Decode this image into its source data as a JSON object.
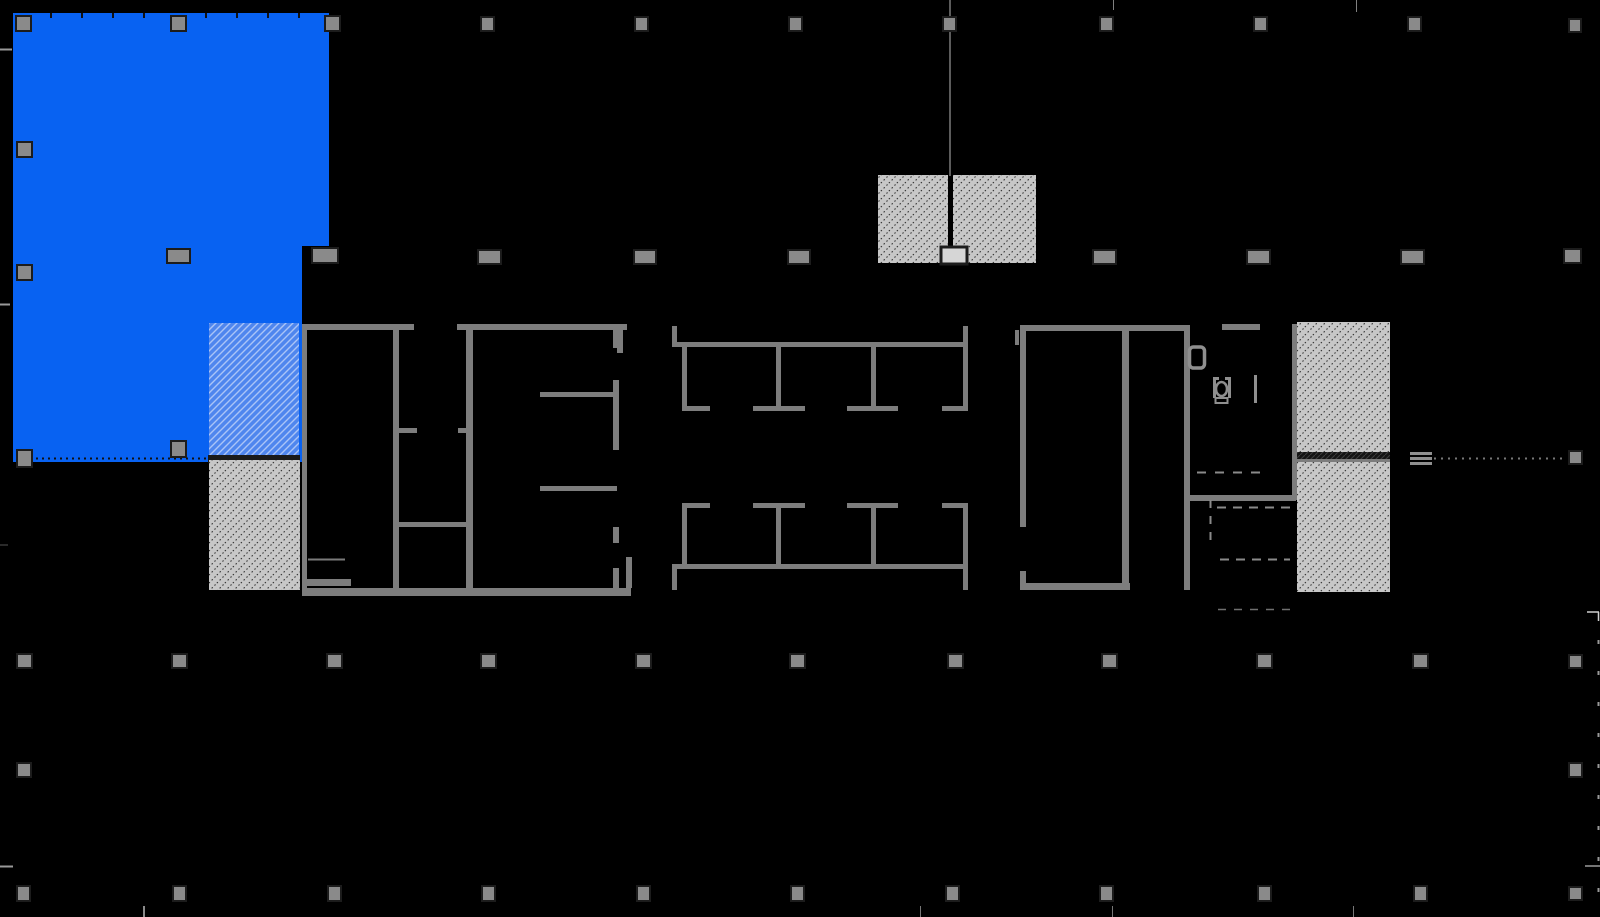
{
  "app": {
    "view_label": "floor-plan-view"
  },
  "canvas": {
    "width": 1600,
    "height": 917,
    "background": "#000000"
  },
  "palette": {
    "background": "#000000",
    "wall": "#7d7d7d",
    "wall_light": "#8f8f8f",
    "column_fill": "#8a8a8a",
    "column_border": "#1c1c1c",
    "selection_blue": "#0862f2",
    "hatch_gray_bg": "#c7c7c7",
    "hatch_gray_line": "#2f2f2f",
    "hatch_blue_bg": "#4f86ee",
    "hatch_blue_line": "#aac4f7",
    "dark_band": "#1a1a1a",
    "tick": "#999999"
  },
  "selection": {
    "suite_polygon": "13,13 329,13 329,246 302,246 302,462 13,462",
    "hatch_rect": [
      209,
      323,
      90,
      134
    ],
    "separator_band": [
      208,
      455,
      92,
      8
    ],
    "edge_dotted_line": {
      "x1": 30,
      "y1": 458.5,
      "x2": 208,
      "y2": 458.5,
      "color": "#101010",
      "dash": "2 4",
      "width": 2
    },
    "mullion_ticks_y": 13,
    "mullion_ticks_x": [
      50,
      81,
      112,
      143,
      205,
      236,
      267,
      298
    ]
  },
  "gray_hatches": [
    [
      209,
      460,
      91,
      130
    ],
    [
      878,
      175,
      70,
      88
    ],
    [
      953,
      175,
      83,
      88
    ],
    [
      1297,
      322,
      93,
      131
    ],
    [
      1297,
      462,
      93,
      130
    ]
  ],
  "dark_bands": [
    [
      1297,
      452,
      93,
      9
    ]
  ],
  "walls": [
    [
      302,
      324,
      112,
      6
    ],
    [
      457,
      324,
      170,
      6
    ],
    [
      302,
      325,
      5,
      271
    ],
    [
      393,
      330,
      6,
      258
    ],
    [
      399,
      428,
      18,
      5
    ],
    [
      458,
      428,
      15,
      5
    ],
    [
      399,
      522,
      74,
      5
    ],
    [
      302,
      579,
      49,
      7
    ],
    [
      302,
      588,
      329,
      8
    ],
    [
      466,
      330,
      7,
      266
    ],
    [
      613,
      330,
      6,
      18
    ],
    [
      613,
      380,
      6,
      70
    ],
    [
      613,
      527,
      6,
      16
    ],
    [
      613,
      568,
      6,
      20
    ],
    [
      540,
      392,
      77,
      5
    ],
    [
      540,
      486,
      77,
      5
    ],
    [
      626,
      557,
      6,
      31
    ],
    [
      617,
      326,
      6,
      27
    ],
    [
      672,
      326,
      5,
      21
    ],
    [
      677,
      342,
      286,
      5
    ],
    [
      963,
      326,
      5,
      21
    ],
    [
      682,
      347,
      5,
      62
    ],
    [
      963,
      347,
      5,
      62
    ],
    [
      776,
      347,
      5,
      61
    ],
    [
      871,
      347,
      5,
      61
    ],
    [
      682,
      406,
      28,
      5
    ],
    [
      753,
      406,
      52,
      5
    ],
    [
      847,
      406,
      51,
      5
    ],
    [
      942,
      406,
      26,
      5
    ],
    [
      682,
      503,
      28,
      5
    ],
    [
      753,
      503,
      52,
      5
    ],
    [
      847,
      503,
      51,
      5
    ],
    [
      942,
      503,
      26,
      5
    ],
    [
      776,
      508,
      5,
      61
    ],
    [
      871,
      508,
      5,
      61
    ],
    [
      682,
      508,
      5,
      61
    ],
    [
      963,
      508,
      5,
      61
    ],
    [
      677,
      564,
      286,
      5
    ],
    [
      672,
      564,
      5,
      26
    ],
    [
      963,
      564,
      5,
      26
    ],
    [
      1020,
      325,
      168,
      6
    ],
    [
      1020,
      325,
      6,
      202
    ],
    [
      1020,
      571,
      6,
      19
    ],
    [
      1020,
      583,
      110,
      7
    ],
    [
      1122,
      331,
      7,
      259
    ],
    [
      1184,
      325,
      6,
      265
    ],
    [
      1222,
      324,
      38,
      6
    ],
    [
      1188,
      495,
      108,
      6
    ],
    [
      1292,
      324,
      5,
      176
    ],
    [
      1015,
      330,
      4,
      15
    ],
    [
      1297,
      459,
      93,
      3
    ]
  ],
  "columns": {
    "solid": [
      [
        16,
        16,
        15,
        15
      ],
      [
        171,
        16,
        15,
        15
      ],
      [
        325,
        16,
        15,
        15
      ],
      [
        481,
        17,
        13,
        14
      ],
      [
        635,
        17,
        13,
        14
      ],
      [
        789,
        17,
        13,
        14
      ],
      [
        943,
        17,
        13,
        14
      ],
      [
        1100,
        17,
        13,
        14
      ],
      [
        1254,
        17,
        13,
        14
      ],
      [
        1408,
        17,
        13,
        14
      ],
      [
        1569,
        19,
        12,
        13
      ],
      [
        17,
        142,
        15,
        15
      ],
      [
        17,
        265,
        15,
        15
      ],
      [
        167,
        249,
        23,
        14
      ],
      [
        312,
        248,
        26,
        15
      ],
      [
        478,
        250,
        23,
        14
      ],
      [
        634,
        250,
        22,
        14
      ],
      [
        788,
        250,
        22,
        14
      ],
      [
        1093,
        250,
        23,
        14
      ],
      [
        1247,
        250,
        23,
        14
      ],
      [
        1401,
        250,
        23,
        14
      ],
      [
        1564,
        249,
        17,
        14
      ],
      [
        17,
        450,
        15,
        17
      ],
      [
        171,
        441,
        15,
        16
      ],
      [
        1569,
        451,
        13,
        13
      ],
      [
        17,
        654,
        15,
        14
      ],
      [
        172,
        654,
        15,
        14
      ],
      [
        327,
        654,
        15,
        14
      ],
      [
        481,
        654,
        15,
        14
      ],
      [
        636,
        654,
        15,
        14
      ],
      [
        790,
        654,
        15,
        14
      ],
      [
        948,
        654,
        15,
        14
      ],
      [
        1102,
        654,
        15,
        14
      ],
      [
        1257,
        654,
        15,
        14
      ],
      [
        1413,
        654,
        15,
        14
      ],
      [
        1569,
        655,
        13,
        13
      ],
      [
        17,
        763,
        14,
        14
      ],
      [
        1569,
        763,
        13,
        14
      ],
      [
        17,
        886,
        13,
        15
      ],
      [
        173,
        886,
        13,
        15
      ],
      [
        328,
        886,
        13,
        15
      ],
      [
        482,
        886,
        13,
        15
      ],
      [
        637,
        886,
        13,
        15
      ],
      [
        791,
        886,
        13,
        15
      ],
      [
        946,
        886,
        13,
        15
      ],
      [
        1100,
        886,
        13,
        15
      ],
      [
        1258,
        886,
        13,
        15
      ],
      [
        1414,
        886,
        13,
        15
      ],
      [
        1569,
        887,
        13,
        13
      ]
    ],
    "outlined": [
      [
        941,
        247,
        26,
        17
      ]
    ]
  },
  "stair_core": {
    "riser_line": {
      "x1": 950,
      "y1": 0,
      "x2": 950,
      "y2": 176,
      "color": "#5c5c5c",
      "width": 2
    }
  },
  "steps_symbol": [
    [
      1410,
      452,
      22,
      3
    ],
    [
      1410,
      457,
      22,
      3
    ],
    [
      1410,
      462,
      22,
      3
    ]
  ],
  "dotted_lines": [
    {
      "x1": 1434,
      "y1": 458.5,
      "x2": 1566,
      "y2": 458.5,
      "color": "#777777",
      "dash": "2 5",
      "width": 2
    }
  ],
  "dashed_lines": [
    {
      "x1": 1197,
      "y1": 472.5,
      "x2": 1265,
      "y2": 472.5,
      "color": "#8a8a8a",
      "dash": "9 9",
      "width": 2
    },
    {
      "x1": 1210.5,
      "y1": 500,
      "x2": 1210.5,
      "y2": 540,
      "color": "#8a8a8a",
      "dash": "8 8",
      "width": 2
    },
    {
      "x1": 1217,
      "y1": 507.5,
      "x2": 1296,
      "y2": 507.5,
      "color": "#8a8a8a",
      "dash": "9 7",
      "width": 2
    },
    {
      "x1": 1220,
      "y1": 559.5,
      "x2": 1290,
      "y2": 559.5,
      "color": "#8a8a8a",
      "dash": "9 7",
      "width": 2
    },
    {
      "x1": 1218,
      "y1": 609.5,
      "x2": 1292,
      "y2": 609.5,
      "color": "#6f6f6f",
      "dash": "8 8",
      "width": 1.5
    },
    {
      "x1": 1598.5,
      "y1": 640,
      "x2": 1598.5,
      "y2": 892,
      "color": "#9a9a9a",
      "dash": "4 27",
      "width": 2
    }
  ],
  "ticks": [
    {
      "x1": 0,
      "y1": 49.5,
      "x2": 12,
      "y2": 49.5,
      "color": "#999999",
      "width": 2
    },
    {
      "x1": 0,
      "y1": 304.5,
      "x2": 10,
      "y2": 304.5,
      "color": "#999999",
      "width": 2
    },
    {
      "x1": 0,
      "y1": 545,
      "x2": 8,
      "y2": 545,
      "color": "#555555",
      "width": 1
    },
    {
      "x1": 0,
      "y1": 866.5,
      "x2": 13,
      "y2": 866.5,
      "color": "#999999",
      "width": 2
    },
    {
      "x1": 1113.5,
      "y1": 0,
      "x2": 1113.5,
      "y2": 10,
      "color": "#808080",
      "width": 1
    },
    {
      "x1": 1356.5,
      "y1": 0,
      "x2": 1356.5,
      "y2": 12,
      "color": "#808080",
      "width": 1
    },
    {
      "x1": 1587,
      "y1": 612,
      "x2": 1599,
      "y2": 612,
      "color": "#cfcfcf",
      "width": 1.5
    },
    {
      "x1": 1598.5,
      "y1": 612,
      "x2": 1598.5,
      "y2": 621,
      "color": "#cfcfcf",
      "width": 1.5
    },
    {
      "x1": 1585,
      "y1": 866,
      "x2": 1600,
      "y2": 866,
      "color": "#9a9a9a",
      "width": 1.5
    },
    {
      "x1": 144,
      "y1": 906,
      "x2": 144,
      "y2": 917,
      "color": "#8a8a8a",
      "width": 2
    },
    {
      "x1": 920.5,
      "y1": 906,
      "x2": 920.5,
      "y2": 917,
      "color": "#777777",
      "width": 1
    },
    {
      "x1": 1112.5,
      "y1": 906,
      "x2": 1112.5,
      "y2": 917,
      "color": "#777777",
      "width": 1
    },
    {
      "x1": 1353.5,
      "y1": 906,
      "x2": 1353.5,
      "y2": 917,
      "color": "#777777",
      "width": 1
    }
  ],
  "fixtures": {
    "door": {
      "rect": [
        1189.5,
        347,
        15,
        21
      ],
      "radius": 4,
      "stroke": "#8f8f8f",
      "width": 3.5
    },
    "toilet": {
      "sides": [
        [
          1213,
          377,
          3,
          21
        ],
        [
          1228,
          377,
          3,
          21
        ]
      ],
      "top_hooks": [
        [
          1213,
          377,
          6,
          3
        ],
        [
          1225,
          377,
          6,
          3
        ]
      ],
      "bowl": {
        "cx": 1221.5,
        "cy": 389,
        "rx": 5.5,
        "ry": 7
      },
      "base": [
        1215.5,
        398,
        12,
        5
      ],
      "stroke": "#8f8f8f"
    },
    "partition_line": [
      1254,
      375,
      3,
      28
    ],
    "counter_line": [
      308,
      558.5,
      37,
      2
    ]
  }
}
